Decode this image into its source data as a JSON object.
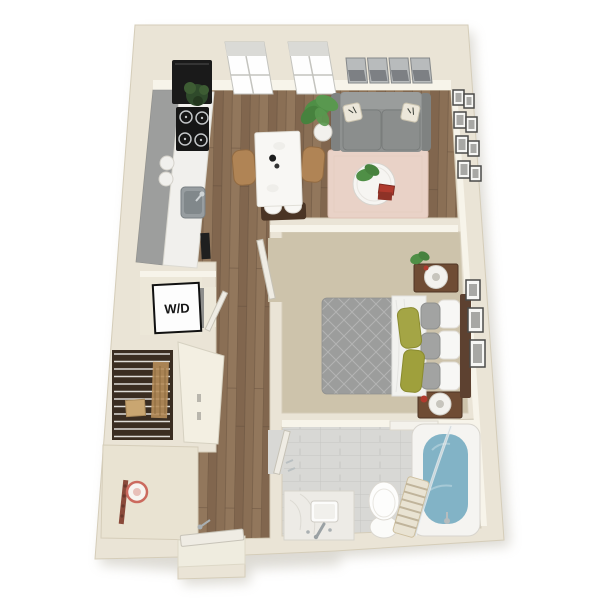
{
  "labels": {
    "wd": "W/D"
  },
  "palette": {
    "bg": "#ffffff",
    "wall": "#eae4d6",
    "wallEdge": "#d5cdb9",
    "wallFace": "#f7f4ea",
    "wood": "#8a6f55",
    "woodDark": "#795f48",
    "woodLight": "#9b8064",
    "carpet": "#cdc3ab",
    "tile": "#d8d8d5",
    "tileLine": "#c6c6c2",
    "rug": "#e9d2c7",
    "sofa": "#8e9190",
    "sofaBack": "#9a9d9c",
    "duvet": "#9c9d9c",
    "sheet": "#f2f2ef",
    "pillowOlive": "#a4a545",
    "pillowGray": "#a2a3a2",
    "headboard": "#5d4130",
    "woodFurn": "#6f4c34",
    "tableTop": "#f8f7f4",
    "chairTan": "#b08455",
    "benchDark": "#4a3424",
    "counterGray": "#9d9e9d",
    "counterWhite": "#f1f0ed",
    "black": "#1a1a1a",
    "steel": "#979da0",
    "water": "#82b3c6",
    "plant": "#4f8f46",
    "plantDark": "#2f4a2b",
    "red": "#b03a2e",
    "closetDark": "#3a2d21",
    "wire": "#ecebe7",
    "tan": "#b68d5a",
    "leaf": "#efece4",
    "entry": "#e9e3d2",
    "rack": "#8a4a3a",
    "frame": "#4a4a48",
    "art": "#b8bbbc"
  }
}
